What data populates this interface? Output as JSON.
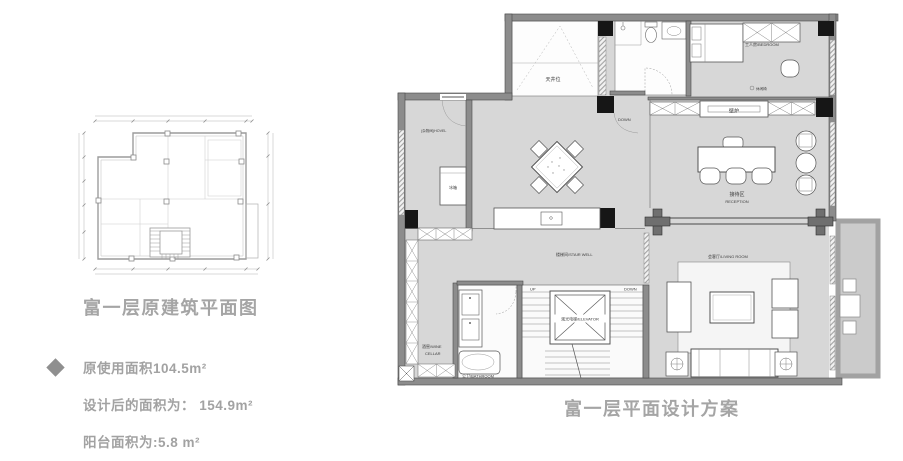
{
  "original_plan": {
    "title": "富一层原建筑平面图"
  },
  "summary": {
    "line1": "原使用面积104.5m²",
    "line2": "设计后的面积为： 154.9m²",
    "line3": "阳台面积为:5.8 m²"
  },
  "design_plan": {
    "title": "富一层平面设计方案",
    "labels": {
      "light_well": "天井位",
      "down_top": "DOWN",
      "storage": "(杂物间)HOVEL",
      "bedroom": "工人房/BEDROOM",
      "leisure_chair": "休闲椅",
      "fireplace": "壁炉",
      "reception_cn": "接待区",
      "reception_en": "RECEPTION",
      "fridge": "冰箱",
      "stair_well": "楼梯间/STAIR WELL",
      "living_room": "会客厅/LIVING ROOM",
      "wine_cellar_line1": "酒窖/WINE",
      "wine_cellar_line2": "CELLAR",
      "bathroom": "公卫/BATHROOM",
      "elevator": "观光电梯/ELEVATOR",
      "up": "UP",
      "down": "DOWN"
    }
  },
  "colors": {
    "text_gray": "#a2a2a2",
    "floor_gray": "#d7d7d7",
    "wall_gray": "#8c8c8c",
    "column_black": "#161616",
    "balcony_gray": "#cbcbcb"
  }
}
